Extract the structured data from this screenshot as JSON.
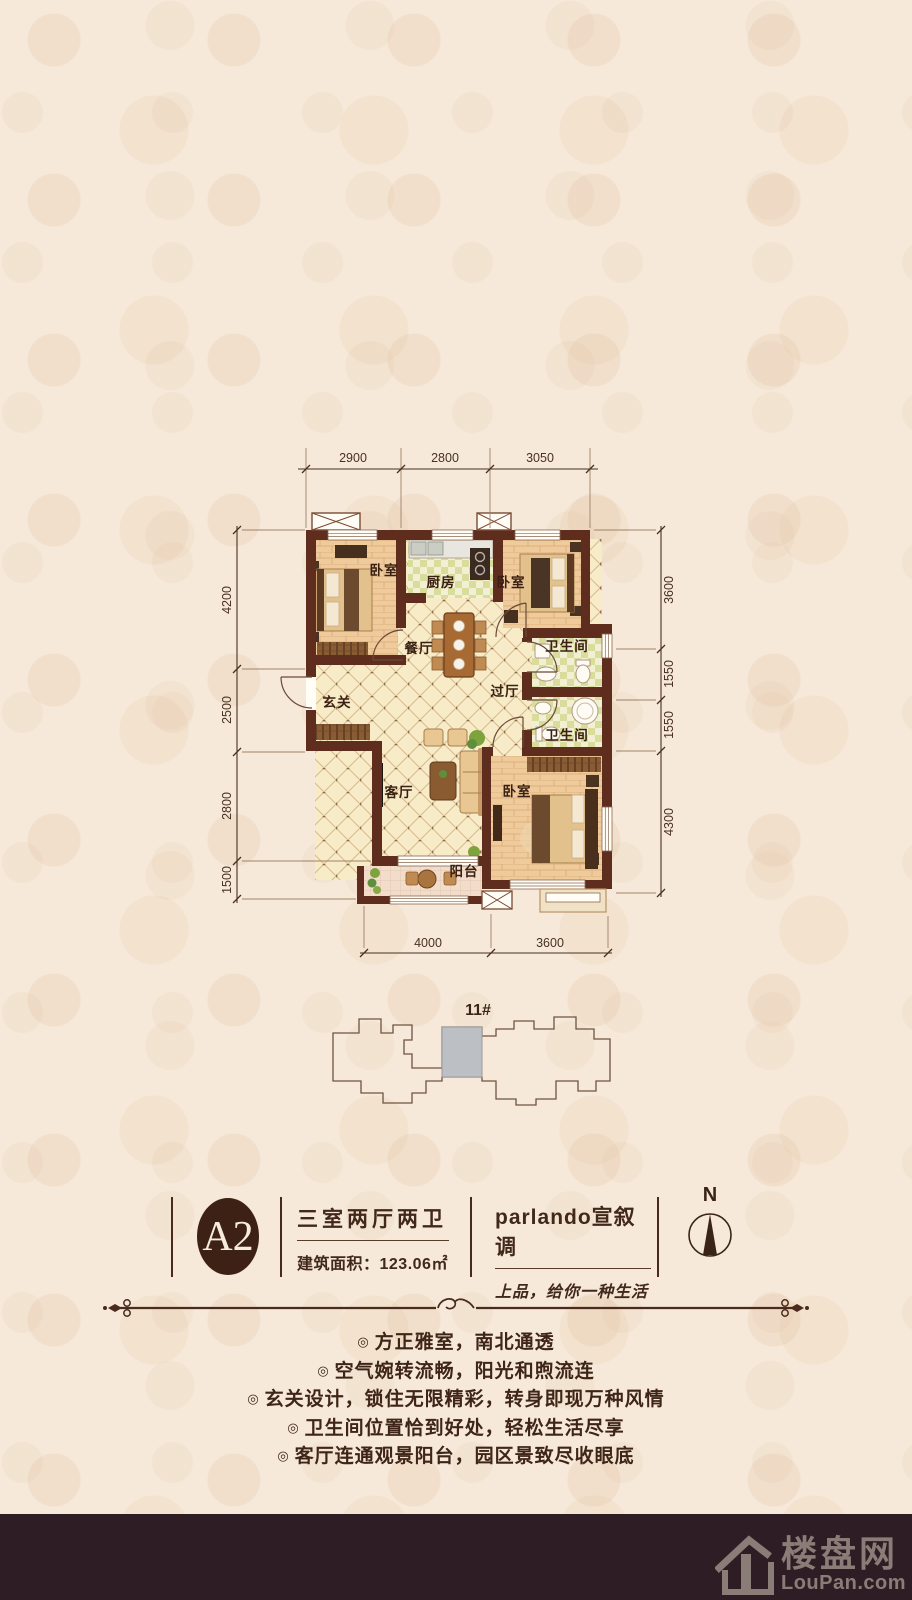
{
  "colors": {
    "wall": "#5e2d1e",
    "accent_text": "#42281a",
    "badge_bg": "#3c2114",
    "footer_bg": "#2e1d25",
    "unit_highlight": "#bcbfc3",
    "dim_text": "#4a3020"
  },
  "plan": {
    "dims": {
      "top": [
        "2900",
        "2800",
        "3050"
      ],
      "left": [
        "4200",
        "2500",
        "2800",
        "1500"
      ],
      "right": [
        "3600",
        "1550",
        "1550",
        "4300"
      ],
      "bottom": [
        "4000",
        "3600"
      ]
    },
    "rooms": {
      "bedroom_top_left": "卧室",
      "kitchen": "厨房",
      "bedroom_top_right": "卧室",
      "dining": "餐厅",
      "bath_upper": "卫生间",
      "foyer": "玄关",
      "hallway": "过厅",
      "bath_lower": "卫生间",
      "living": "客厅",
      "bedroom_bottom": "卧室",
      "balcony": "阳台"
    }
  },
  "key_plan": {
    "building_label": "11#"
  },
  "info": {
    "unit_code": "A2",
    "layout": "三室两厅两卫",
    "area": "建筑面积：123.06㎡",
    "brand": "parlando宣叙调",
    "slogan": "上品，给你一种生活",
    "compass_label": "N"
  },
  "features": {
    "marker": "◎",
    "items": [
      "方正雅室，南北通透",
      "空气婉转流畅，阳光和煦流连",
      "玄关设计，锁住无限精彩，转身即现万种风情",
      "卫生间位置恰到好处，轻松生活尽享",
      "客厅连通观景阳台，园区景致尽收眼底"
    ]
  },
  "watermark": {
    "site_name": "楼盘网",
    "site_domain": "LouPan.com"
  }
}
